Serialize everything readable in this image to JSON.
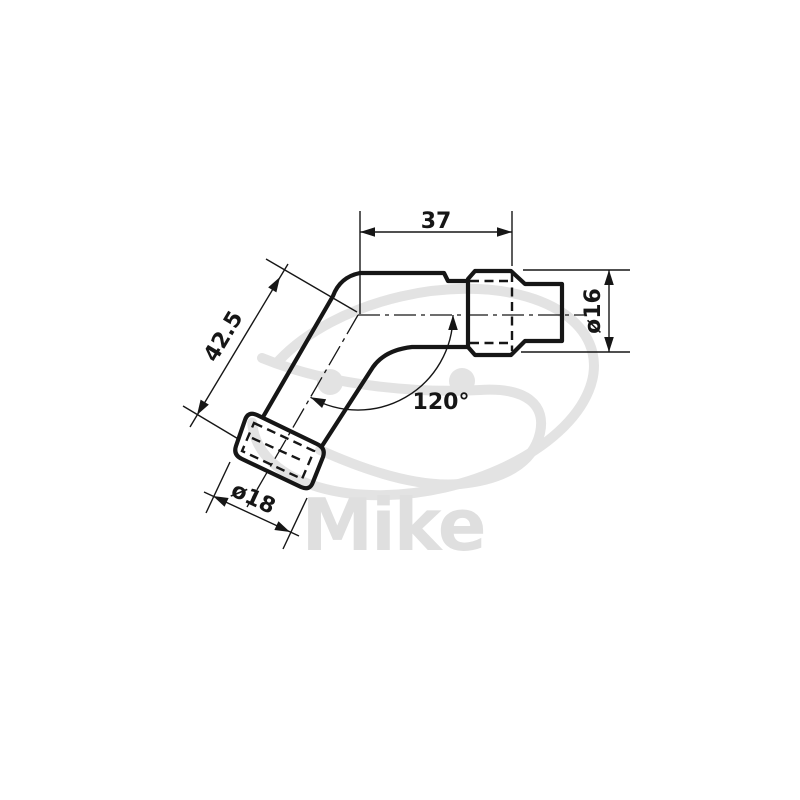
{
  "drawing": {
    "type": "technical-dimension-drawing",
    "subject": "angled spark plug cap (120° elbow connector)",
    "labels": {
      "top_width": "37",
      "body_length": "42.5",
      "angle": "120°",
      "terminal_diameter": "ø16",
      "boot_diameter": "ø18"
    }
  },
  "watermark": {
    "text": "Mike"
  },
  "colors": {
    "line": "#161616",
    "watermark_swirl": "#e3e3e3",
    "watermark_text": "#dfdfdf",
    "background": "#ffffff"
  }
}
